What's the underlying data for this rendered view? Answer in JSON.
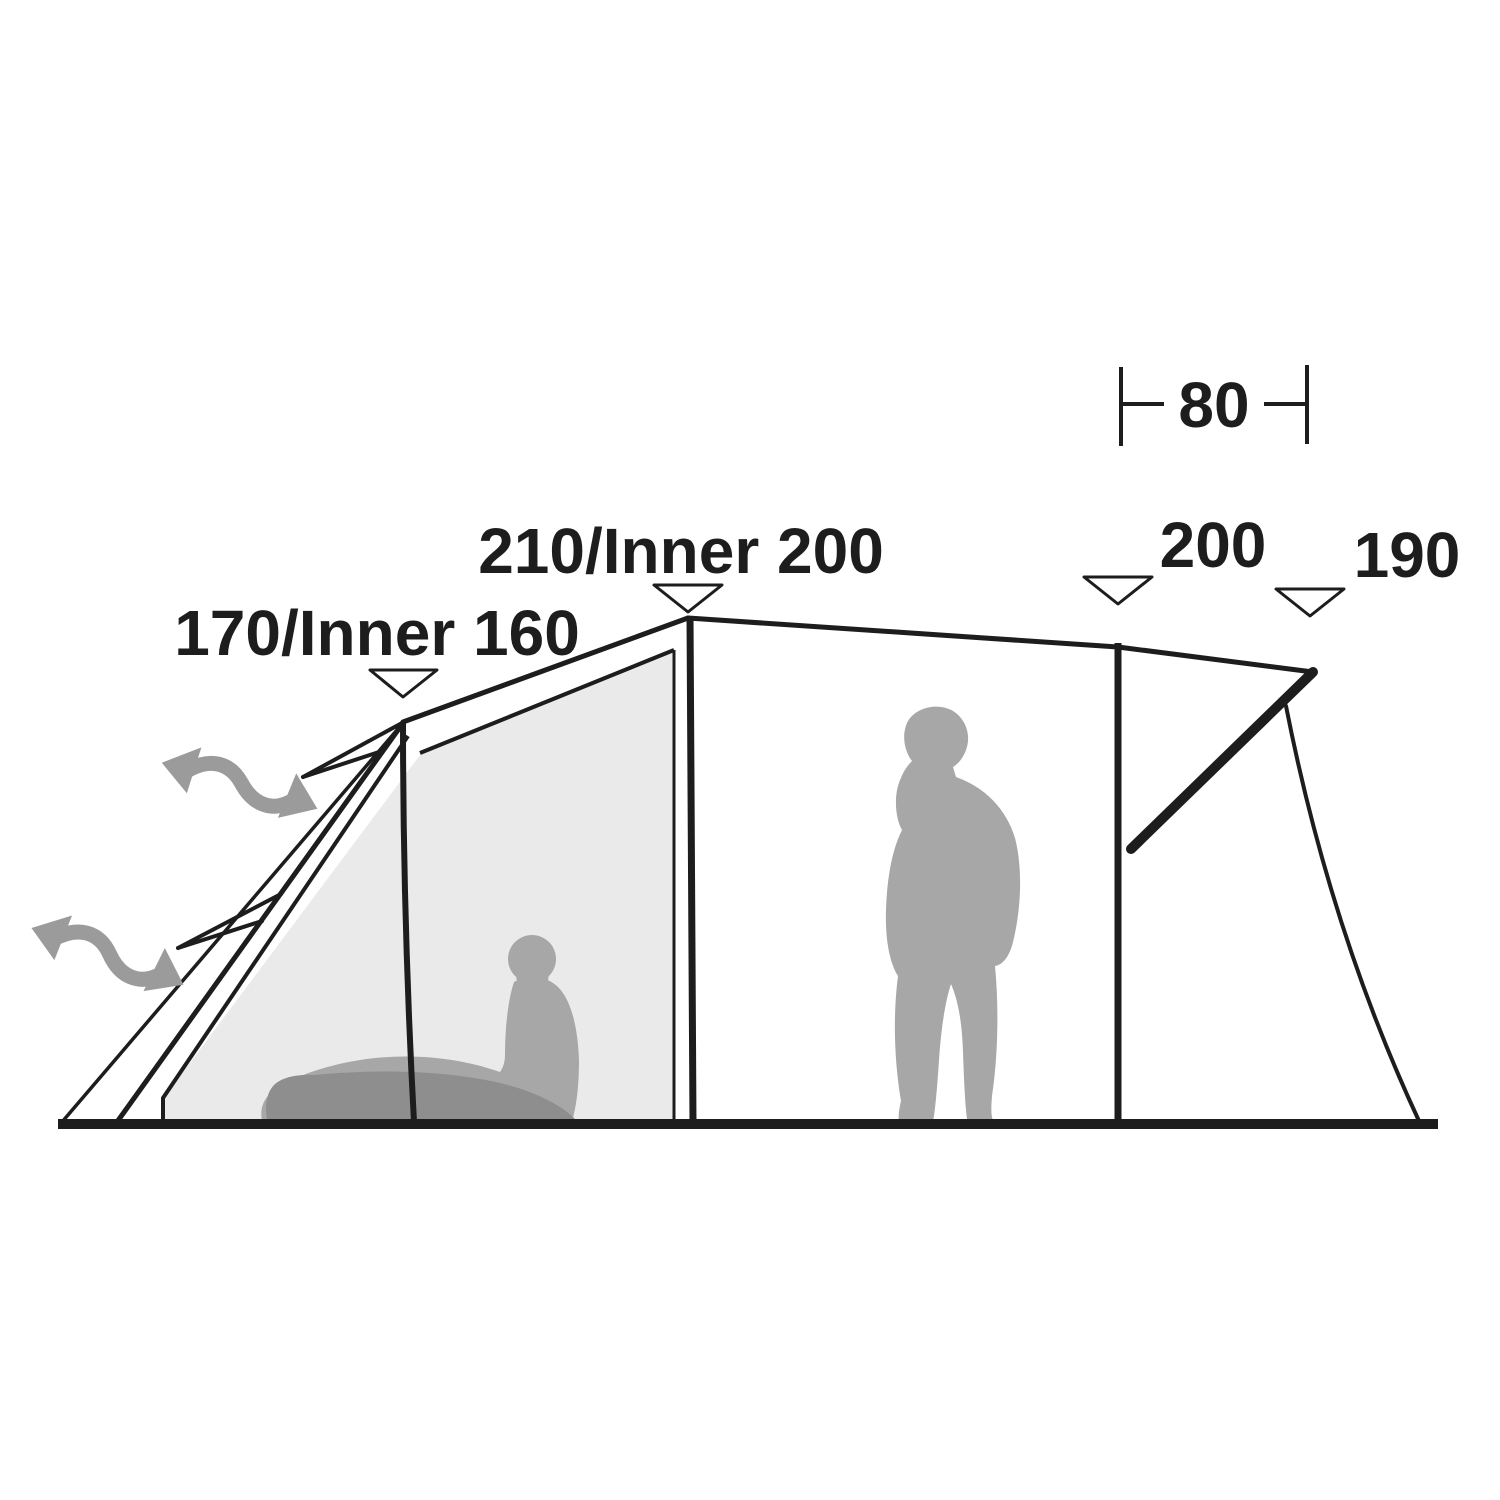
{
  "diagram_title": "Tent side profile with dimensions",
  "labels": {
    "bedroom_peak": "170/Inner 160",
    "main_peak": "210/Inner 200",
    "porch_depth": "80",
    "entrance_height": "200",
    "awning_height": "190"
  },
  "icons": {
    "pointer": "down-triangle",
    "ventilation": "wavy-double-arrow"
  },
  "colors": {
    "ink": "#1d1d1d",
    "paper": "#ffffff",
    "inner_fill": "#eaeaea",
    "person_gray": "#a7a7a7",
    "mat_gray": "#8e8e8e",
    "arrow_gray": "#9b9b9b"
  }
}
